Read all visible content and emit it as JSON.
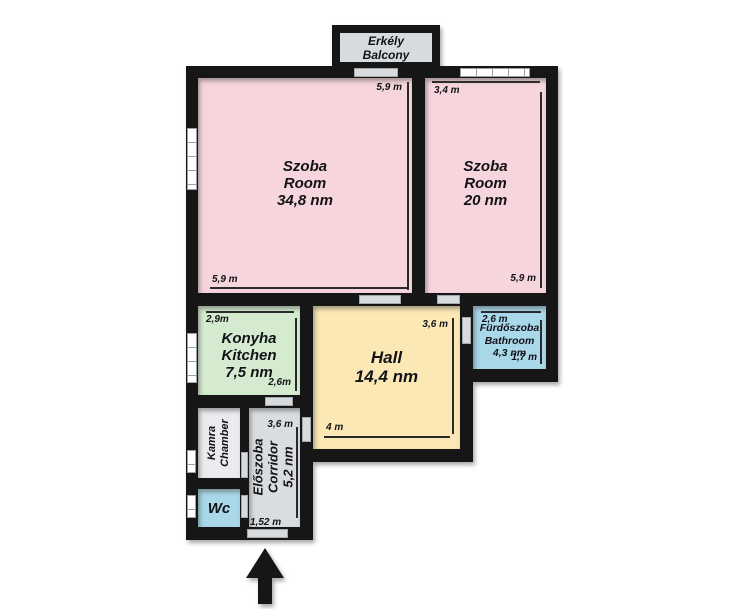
{
  "colors": {
    "wall": "#161616",
    "room_pink": "#f6d6dc",
    "kitchen_green": "#d5ebcf",
    "hall_yellow": "#fbe8b5",
    "water_blue": "#a9d8e9",
    "corridor_gray": "#dadde0",
    "chamber_gray": "#e9ebee",
    "balcony_gray": "#d7dbde"
  },
  "balcony": {
    "name_hu": "Erkély",
    "name_en": "Balcony"
  },
  "rooms": {
    "room_large": {
      "name_hu": "Szoba",
      "name_en": "Room",
      "area": "34,8 nm",
      "dim_right": "5,9 m",
      "dim_bottom": "5,9 m"
    },
    "room_small": {
      "name_hu": "Szoba",
      "name_en": "Room",
      "area": "20 nm",
      "dim_top": "3,4 m",
      "dim_right": "5,9 m"
    },
    "kitchen": {
      "name_hu": "Konyha",
      "name_en": "Kitchen",
      "area": "7,5 nm",
      "dim_top": "2,9m",
      "dim_right": "2,6m"
    },
    "hall": {
      "name": "Hall",
      "area": "14,4 nm",
      "dim_right": "3,6 m",
      "dim_bottom": "4 m"
    },
    "bathroom": {
      "name_hu": "Fürdőszoba",
      "name_en": "Bathroom",
      "area": "4,3 nm",
      "dim_top": "2,6 m",
      "dim_right": "1,7 m"
    },
    "chamber": {
      "name_hu": "Kamra",
      "name_en": "Chamber"
    },
    "wc": {
      "name": "Wc"
    },
    "corridor": {
      "name_hu": "Előszoba",
      "name_en": "Corridor",
      "area": "5,2 nm",
      "dim_right": "3,6 m",
      "dim_bottom": "1,52 m"
    }
  },
  "entrance": {
    "icon": "up-arrow"
  }
}
